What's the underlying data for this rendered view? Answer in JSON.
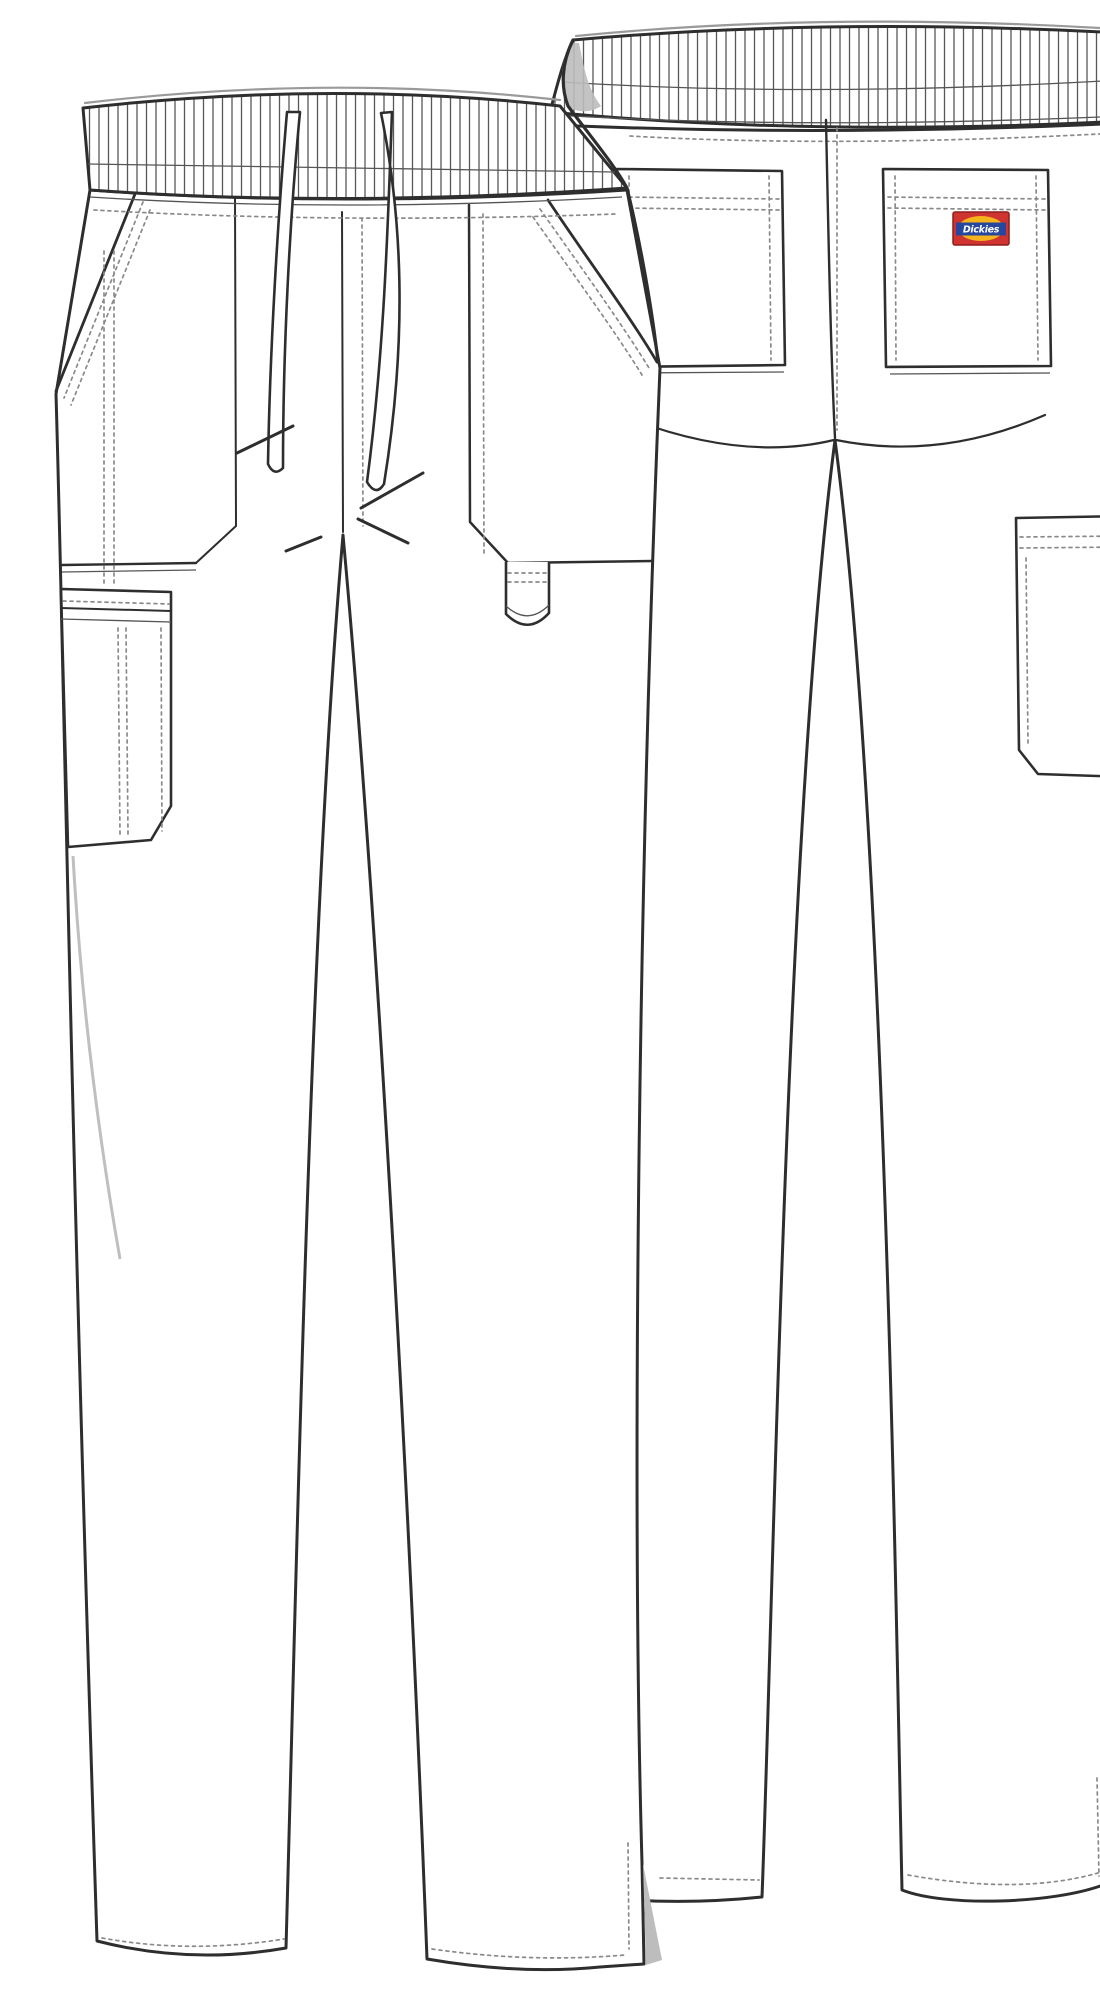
{
  "image": {
    "type": "garment-technical-flat-sketch",
    "subject": "Scrub pants technical drawing, front and back views",
    "views": [
      "front",
      "back"
    ]
  },
  "logo": {
    "text": "Dickies",
    "patch_bg": "#cf3430",
    "patch_border": "#8f1f1c",
    "band_color": "#27479e",
    "accent_color": "#f5b31c",
    "text_color": "#ffffff"
  },
  "palette": {
    "background": "#ffffff",
    "ink": "#2e2e2e",
    "stitch_gray": "#8a8a8a",
    "shading_gray": "#bdbdbd"
  },
  "front_view": {
    "name": "front",
    "features": [
      "elastic-ribbed-waistband",
      "drawstring",
      "slash-pockets",
      "right-patch-pocket",
      "instrument-loop",
      "left-side-cargo-pocket"
    ]
  },
  "back_view": {
    "name": "back",
    "features": [
      "elastic-ribbed-waistband",
      "two-back-patch-pockets",
      "logo-patch-on-right-pocket",
      "right-side-cargo-pocket",
      "hem-vent"
    ]
  }
}
